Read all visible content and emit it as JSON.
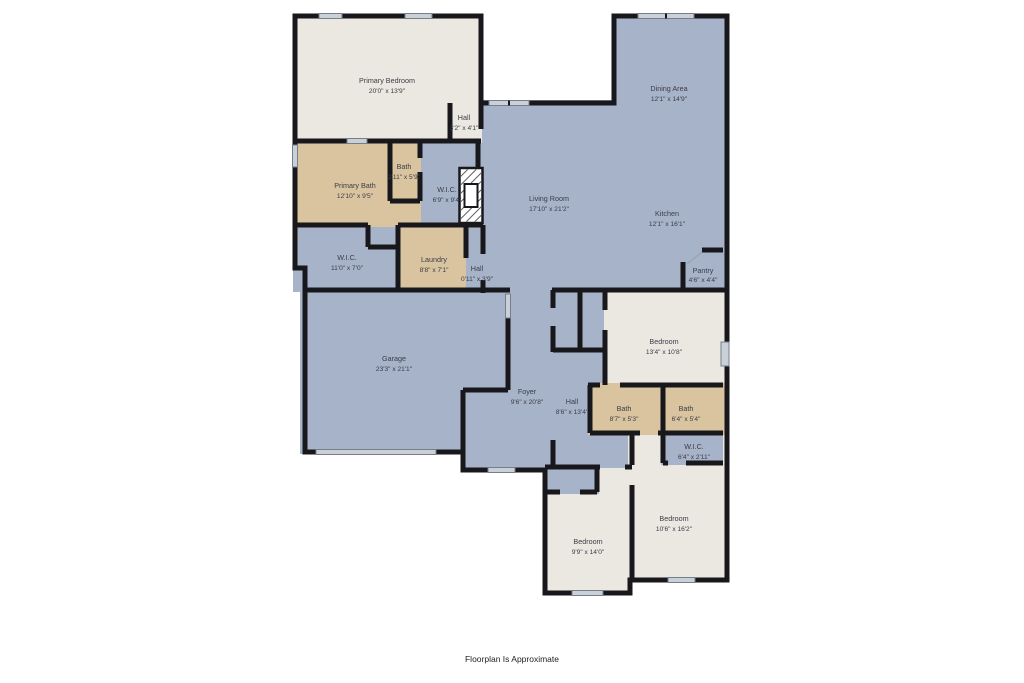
{
  "footer": {
    "note": "Floorplan Is Approximate"
  },
  "palette": {
    "room_blue": "#a6b3c9",
    "room_beige": "#eae8e0",
    "room_tan": "#d9c49f",
    "wall": "#18181c",
    "window": "#c9d0d8",
    "label_text": "#3c3c47"
  },
  "rooms": [
    {
      "name": "Primary Bedroom",
      "dims": "20'0\" x 13'9\""
    },
    {
      "name": "Hall",
      "dims": "3'2\" x 4'1\""
    },
    {
      "name": "Dining Area",
      "dims": "12'1\" x 14'9\""
    },
    {
      "name": "Bath",
      "dims": "2'11\" x 5'9\""
    },
    {
      "name": "Primary Bath",
      "dims": "12'10\" x 9'5\""
    },
    {
      "name": "W.I.C.",
      "dims": "6'9\" x 9'4\""
    },
    {
      "name": "Living Room",
      "dims": "17'10\" x 21'2\""
    },
    {
      "name": "Kitchen",
      "dims": "12'1\" x 16'1\""
    },
    {
      "name": "W.I.C.",
      "dims": "11'0\" x 7'0\""
    },
    {
      "name": "Laundry",
      "dims": "8'8\" x 7'1\""
    },
    {
      "name": "Hall",
      "dims": "0'11\" x 3'9\""
    },
    {
      "name": "Pantry",
      "dims": "4'6\" x 4'4\""
    },
    {
      "name": "Garage",
      "dims": "23'3\" x 21'1\""
    },
    {
      "name": "Bedroom",
      "dims": "13'4\" x 10'8\""
    },
    {
      "name": "Foyer",
      "dims": "9'6\" x 20'8\""
    },
    {
      "name": "Hall",
      "dims": "8'6\" x 13'4\""
    },
    {
      "name": "Bath",
      "dims": "8'7\" x 5'3\""
    },
    {
      "name": "Bath",
      "dims": "6'4\" x 5'4\""
    },
    {
      "name": "W.I.C.",
      "dims": "6'4\" x 2'11\""
    },
    {
      "name": "Bedroom",
      "dims": "10'6\" x 16'2\""
    },
    {
      "name": "Bedroom",
      "dims": "9'9\" x 14'0\""
    }
  ]
}
